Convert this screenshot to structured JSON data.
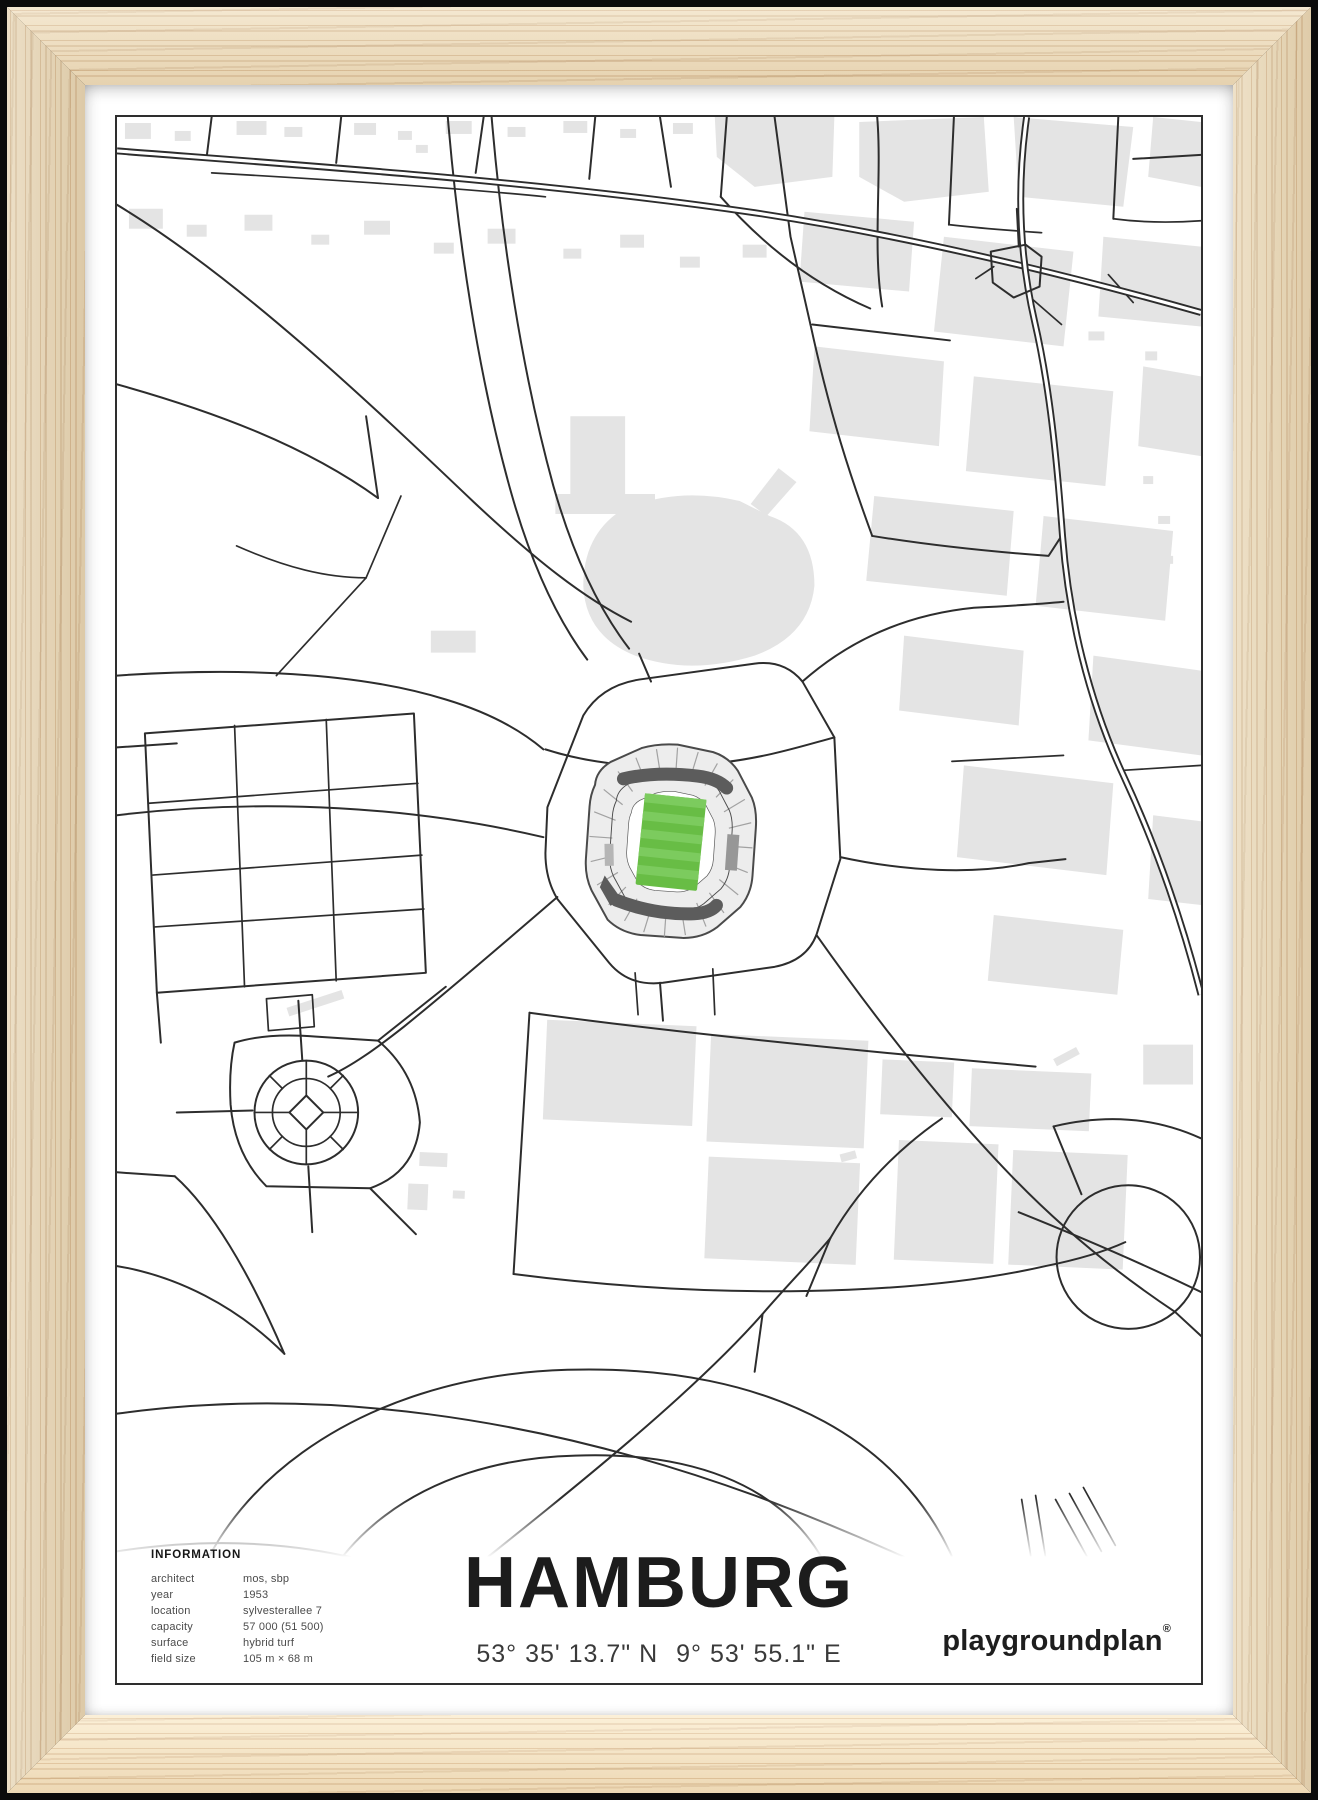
{
  "poster": {
    "title": "HAMBURG",
    "coordinates": {
      "lat": "53° 35' 13.7\" N",
      "lon": "9° 53' 55.1\" E"
    },
    "brand": {
      "name": "playgroundplan",
      "reg": "®"
    },
    "info": {
      "header": "INFORMATION",
      "rows": [
        {
          "label": "architect",
          "value": "mos, sbp"
        },
        {
          "label": "year",
          "value": "1953"
        },
        {
          "label": "location",
          "value": "sylvesterallee 7"
        },
        {
          "label": "capacity",
          "value": "57 000 (51 500)"
        },
        {
          "label": "surface",
          "value": "hybrid turf"
        },
        {
          "label": "field size",
          "value": "105 m × 68 m"
        }
      ]
    }
  },
  "colors": {
    "wood": "#f0dfbe",
    "line": "#2d2d2d",
    "building": "#e4e4e4",
    "shell": "#ededed",
    "tier": "#5c5c5c",
    "pitch-green": "#68bd45",
    "pitch-stripe": "#7ccb5e"
  }
}
